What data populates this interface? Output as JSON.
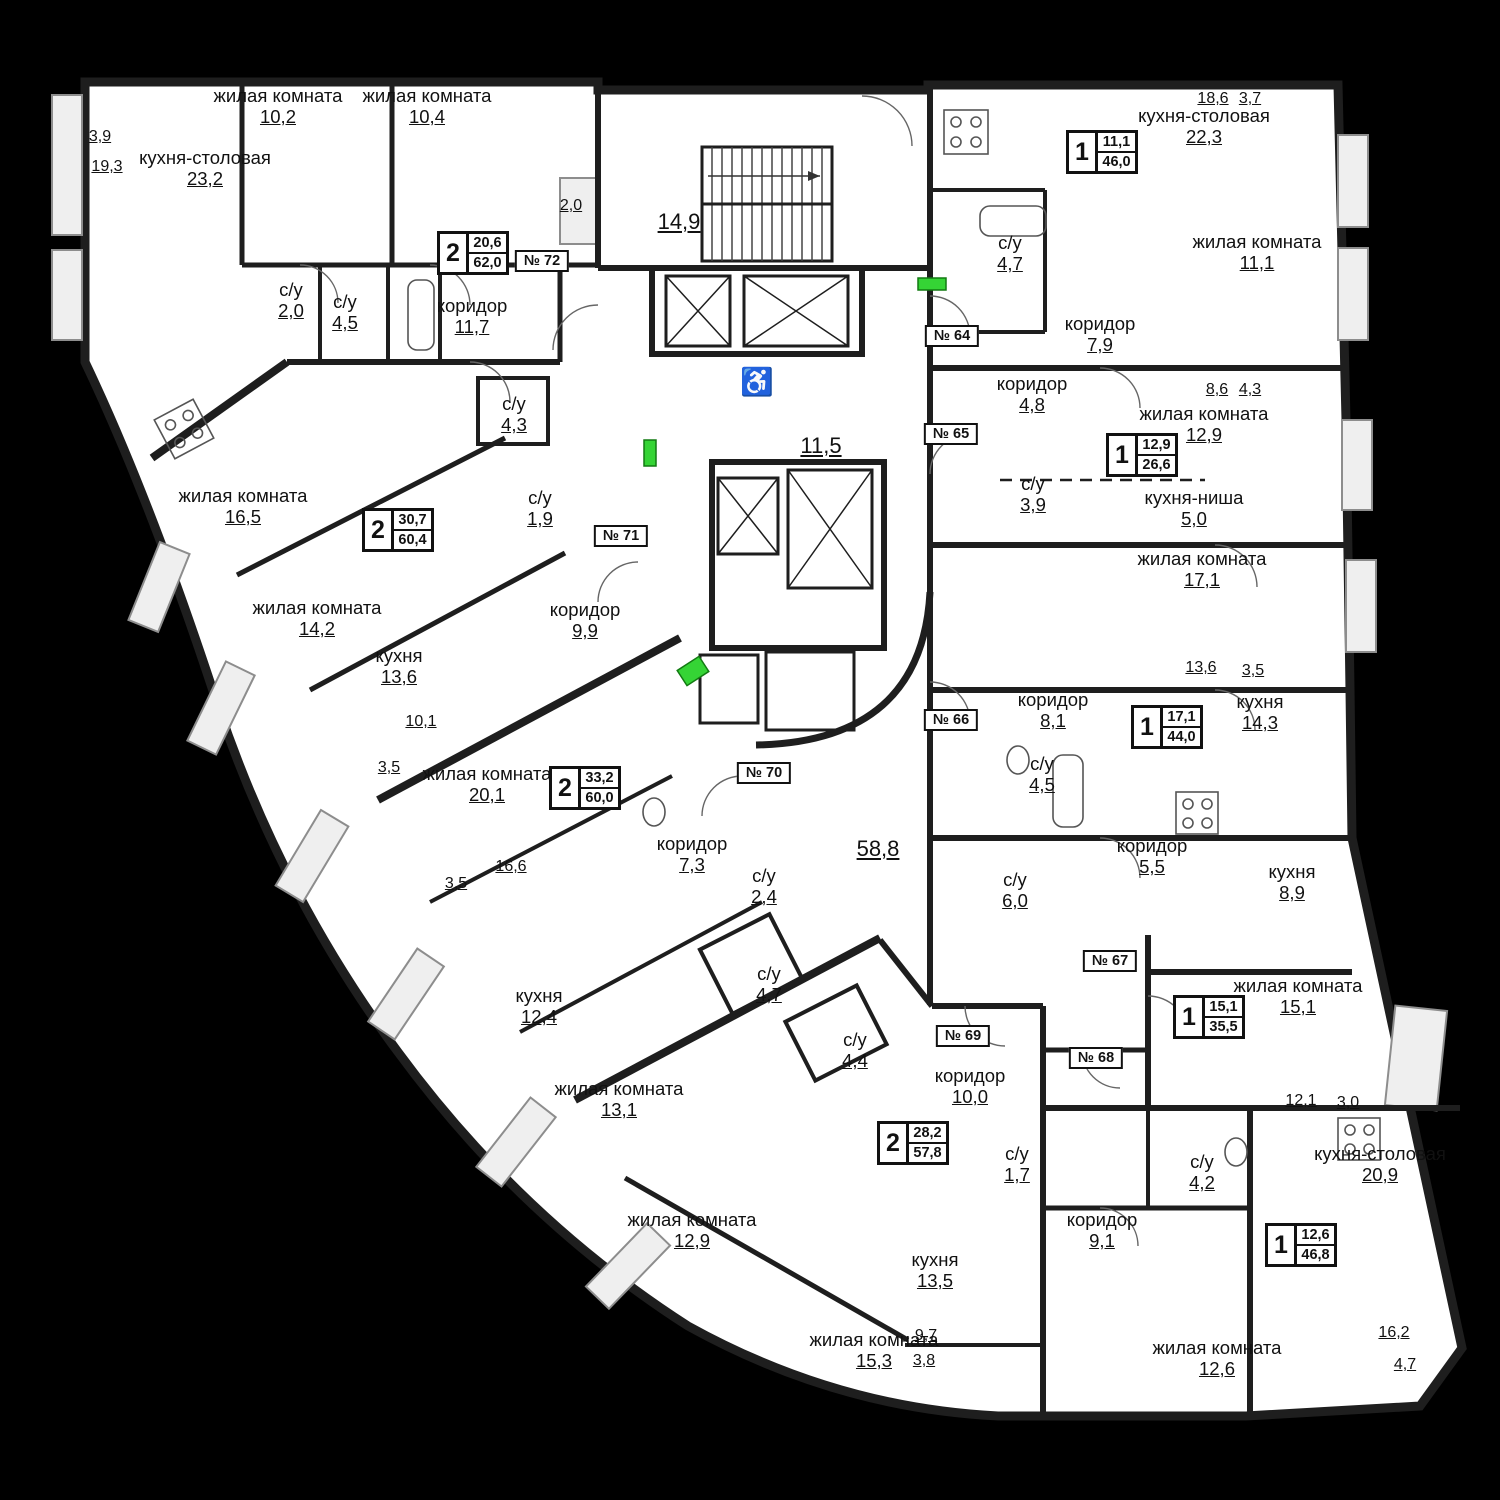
{
  "apartments": [
    {
      "door": "№ 72",
      "rooms_count": "2",
      "living_area": "20,6",
      "total_area": "62,0"
    },
    {
      "door": "№ 71",
      "rooms_count": "2",
      "living_area": "30,7",
      "total_area": "60,4"
    },
    {
      "door": "№ 70",
      "rooms_count": "2",
      "living_area": "33,2",
      "total_area": "60,0"
    },
    {
      "door": "№ 69",
      "rooms_count": "2",
      "living_area": "28,2",
      "total_area": "57,8"
    },
    {
      "door": "№ 64",
      "rooms_count": "1",
      "living_area": "11,1",
      "total_area": "46,0"
    },
    {
      "door": "№ 65",
      "rooms_count": "1",
      "living_area": "12,9",
      "total_area": "26,6"
    },
    {
      "door": "№ 66",
      "rooms_count": "1",
      "living_area": "17,1",
      "total_area": "44,0"
    },
    {
      "door": "№ 67",
      "rooms_count": "1",
      "living_area": "15,1",
      "total_area": "35,5"
    },
    {
      "door": "№ 68",
      "rooms_count": "1",
      "living_area": "12,6",
      "total_area": "46,8"
    }
  ],
  "rooms": [
    {
      "name": "кухня-столовая",
      "area": "23,2"
    },
    {
      "name": "жилая комната",
      "area": "10,2"
    },
    {
      "name": "жилая комната",
      "area": "10,4"
    },
    {
      "name": "с/у",
      "area": "2,0"
    },
    {
      "name": "с/у",
      "area": "4,5"
    },
    {
      "name": "коридор",
      "area": "11,7"
    },
    {
      "name": "с/у",
      "area": "4,3"
    },
    {
      "name": "жилая комната",
      "area": "16,5"
    },
    {
      "name": "жилая комната",
      "area": "14,2"
    },
    {
      "name": "кухня",
      "area": "13,6"
    },
    {
      "name": "с/у",
      "area": "1,9"
    },
    {
      "name": "коридор",
      "area": "9,9"
    },
    {
      "name": "жилая комната",
      "area": "20,1"
    },
    {
      "name": "коридор",
      "area": "7,3"
    },
    {
      "name": "с/у",
      "area": "2,4"
    },
    {
      "name": "с/у",
      "area": "4,7"
    },
    {
      "name": "с/у",
      "area": "4,4"
    },
    {
      "name": "кухня",
      "area": "12,4"
    },
    {
      "name": "жилая комната",
      "area": "13,1"
    },
    {
      "name": "жилая комната",
      "area": "12,9"
    },
    {
      "name": "жилая комната",
      "area": "15,3"
    },
    {
      "name": "кухня",
      "area": "13,5"
    },
    {
      "name": "коридор",
      "area": "10,0"
    },
    {
      "name": "с/у",
      "area": "1,7"
    },
    {
      "name": "коридор",
      "area": "9,1"
    },
    {
      "name": "жилая комната",
      "area": "12,6"
    },
    {
      "name": "кухня-столовая",
      "area": "20,9"
    },
    {
      "name": "с/у",
      "area": "4,2"
    },
    {
      "name": "жилая комната",
      "area": "15,1"
    },
    {
      "name": "кухня",
      "area": "8,9"
    },
    {
      "name": "коридор",
      "area": "5,5"
    },
    {
      "name": "с/у",
      "area": "6,0"
    },
    {
      "name": "с/у",
      "area": "4,5"
    },
    {
      "name": "кухня",
      "area": "14,3"
    },
    {
      "name": "коридор",
      "area": "8,1"
    },
    {
      "name": "жилая комната",
      "area": "17,1"
    },
    {
      "name": "кухня-ниша",
      "area": "5,0"
    },
    {
      "name": "с/у",
      "area": "3,9"
    },
    {
      "name": "жилая комната",
      "area": "12,9"
    },
    {
      "name": "коридор",
      "area": "4,8"
    },
    {
      "name": "коридор",
      "area": "7,9"
    },
    {
      "name": "жилая комната",
      "area": "11,1"
    },
    {
      "name": "с/у",
      "area": "4,7"
    },
    {
      "name": "кухня-столовая",
      "area": "22,3"
    }
  ],
  "dims": [
    {
      "v": "3,9"
    },
    {
      "v": "19,3"
    },
    {
      "v": "2,0"
    },
    {
      "v": "18,6"
    },
    {
      "v": "3,7"
    },
    {
      "v": "8,6"
    },
    {
      "v": "4,3"
    },
    {
      "v": "13,6"
    },
    {
      "v": "3,5"
    },
    {
      "v": "12,1"
    },
    {
      "v": "3,0"
    },
    {
      "v": "16,2"
    },
    {
      "v": "4,7"
    },
    {
      "v": "9,7"
    },
    {
      "v": "3,8"
    },
    {
      "v": "16,6"
    },
    {
      "v": "3,5"
    },
    {
      "v": "10,1"
    },
    {
      "v": "3,5"
    }
  ],
  "core": {
    "stair_area": "14,9",
    "elevator_lobby_area": "11,5",
    "hall_area": "58,8",
    "wheelchair_icon": "♿"
  }
}
